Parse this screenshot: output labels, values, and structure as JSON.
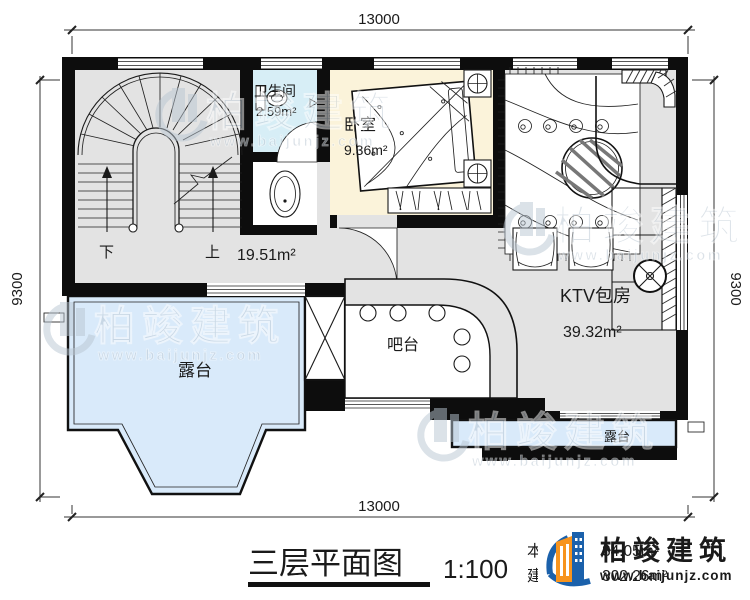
{
  "dimensions": {
    "top": "13000",
    "bottom": "13000",
    "left": "9300",
    "right": "9300"
  },
  "rooms": {
    "stair_hall": {
      "area": "19.51m²",
      "down_label": "下",
      "up_label": "上"
    },
    "bathroom": {
      "name": "卫生间",
      "area": "2.59m²"
    },
    "bedroom": {
      "name": "卧室",
      "area": "9.36m²"
    },
    "ktv": {
      "name": "KTV包房",
      "area": "39.32m²"
    },
    "bar": {
      "name": "吧台"
    },
    "terrace_main": {
      "name": "露台"
    },
    "terrace_small": {
      "name": "露台"
    }
  },
  "titleblock": {
    "plan_title": "三层平面图",
    "scale": "1:100",
    "floor_area_label": "本层面积:",
    "floor_area_value": "84.05m²",
    "gross_area_label": "建筑面积:",
    "gross_area_value": "302.26m²"
  },
  "brand": {
    "name": "柏竣建筑",
    "website": "www.baijunjz.com"
  },
  "watermark": {
    "name": "柏竣建筑",
    "website": "www.baijunjz.com"
  },
  "colors": {
    "wall": "#0d0d0d",
    "floor": "#e3e3e3",
    "bathroom": "#d7eef6",
    "bedroom": "#fbf3da",
    "terrace": "#d9eafa",
    "brand_blue": "#1b61ab",
    "brand_orange": "#f7941e",
    "ink": "#1a1a1a"
  }
}
